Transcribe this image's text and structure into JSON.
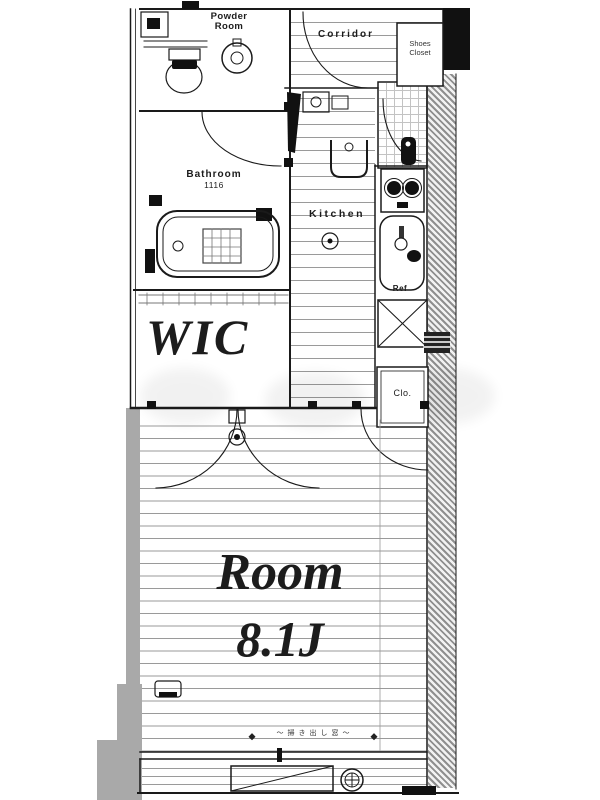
{
  "floorplan": {
    "labels": {
      "powder_room": {
        "line1": "Powder",
        "line2": "Room"
      },
      "corridor": "Corridor",
      "shoes_closet": {
        "line1": "Shoes",
        "line2": "Closet"
      },
      "bathroom": {
        "name": "Bathroom",
        "size": "1116"
      },
      "kitchen": "Kitchen",
      "refrigerator": "Ref",
      "wic": "WIC",
      "closet": "Clo.",
      "room": {
        "name": "Room",
        "size": "8.1J"
      },
      "window_note": "～掃き出し窓～"
    },
    "icons": [
      "water-heater-icon",
      "toilet-icon",
      "washbasin-icon",
      "entrance-door-leaf-icon",
      "washer-pan-icon",
      "bathtub-icon",
      "shower-grid-icon",
      "gas-outlet-icon",
      "stove-icon",
      "sink-icon",
      "refrigerator-space-icon",
      "meter-box-icon",
      "door-handle-icon",
      "ac-outlet-icon",
      "balcony-slope-icon",
      "drain-icon"
    ],
    "colors": {
      "line": "#1a1a1a",
      "floor_line": "#9a9a9a",
      "hatch": "#8f8f8f",
      "wall_gray": "#a9a9a9",
      "text": "#1c1c1c"
    }
  }
}
